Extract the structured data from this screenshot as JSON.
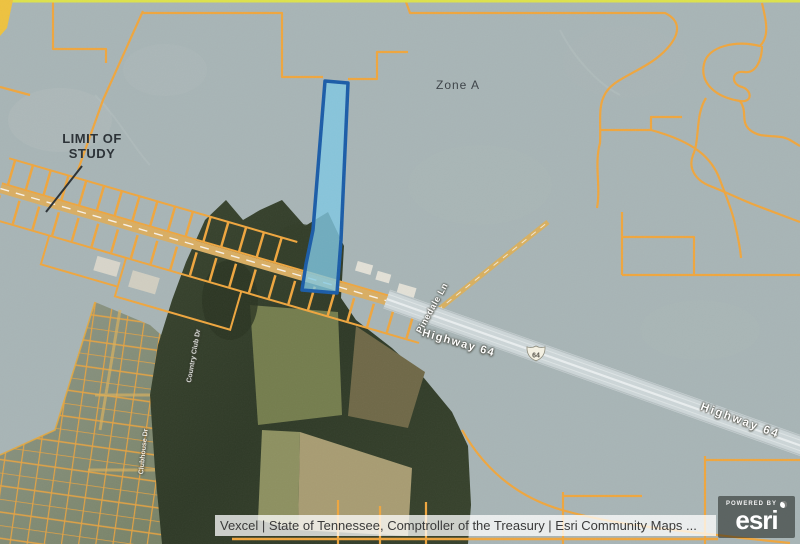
{
  "map": {
    "zone_label": "Zone A",
    "annotation": {
      "line1": "LIMIT OF",
      "line2": "STUDY"
    },
    "road_labels": {
      "highway_center": "Highway 64",
      "highway_right": "Highway 64",
      "side_road": "Pinedale Ln",
      "street_1": "Country Club Dr",
      "street_2": "Clubhouse Dr"
    },
    "route_shield": "64",
    "colors": {
      "flood_zone_overlay": "#a8b5b6",
      "parcel_boundary": "#efa63e",
      "selected_parcel_outline": "#1a5ca8",
      "selected_parcel_fill": "#7fc8e4",
      "highway_surface": "#cdd6d8",
      "study_border_accent": "#dde24b"
    }
  },
  "attribution": {
    "text": "Vexcel | State of Tennessee, Comptroller of the Treasury | Esri Community Maps ..."
  },
  "branding": {
    "powered_by": "POWERED BY",
    "logo_text": "esri"
  }
}
